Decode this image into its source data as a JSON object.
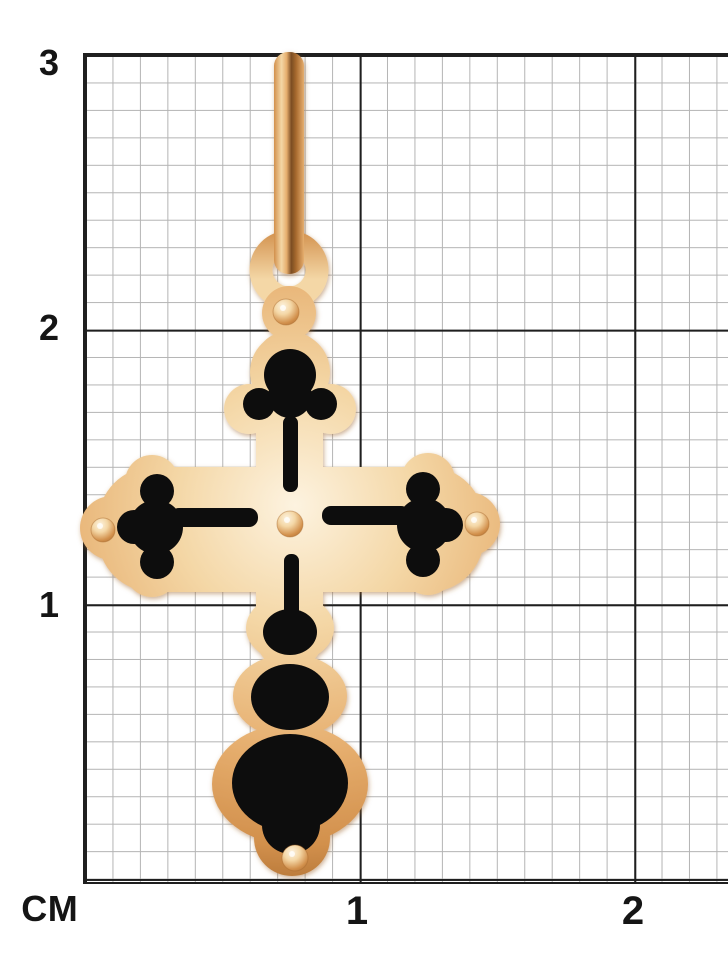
{
  "page": {
    "background": "#ffffff"
  },
  "ruler": {
    "unit_label": "СМ",
    "y_axis_labels": [
      {
        "text": "3"
      },
      {
        "text": "2"
      },
      {
        "text": "1"
      }
    ],
    "x_axis_labels": [
      {
        "text": "1"
      },
      {
        "text": "2"
      }
    ],
    "cm_in_px": 275,
    "minor_cells_per_cm": 10,
    "colors": {
      "major_line": "#1f1f1f",
      "minor_line": "#b4b4b4",
      "page_bg": "#ffffff"
    }
  },
  "pendant": {
    "description": "Rose-gold Orthodox budded cross pendant with black enamel inlays, hanging ring bail and suspension wire, photographed over a centimeter grid",
    "parts": {
      "wire": "suspension wire",
      "bail": "ring bail",
      "body": "trefoil cross body in gold",
      "inlay": "black enamel inlays",
      "rivets": "five gold bead rivets"
    },
    "colors": {
      "gold_highlight": "#fdf3e0",
      "gold_light": "#f4d7a6",
      "gold_mid": "#e6ae6e",
      "gold_deep": "#d2904c",
      "gold_dark": "#a96b2f",
      "wire_shadow": "#7a4c22",
      "enamel_black": "#0e0b08"
    }
  }
}
